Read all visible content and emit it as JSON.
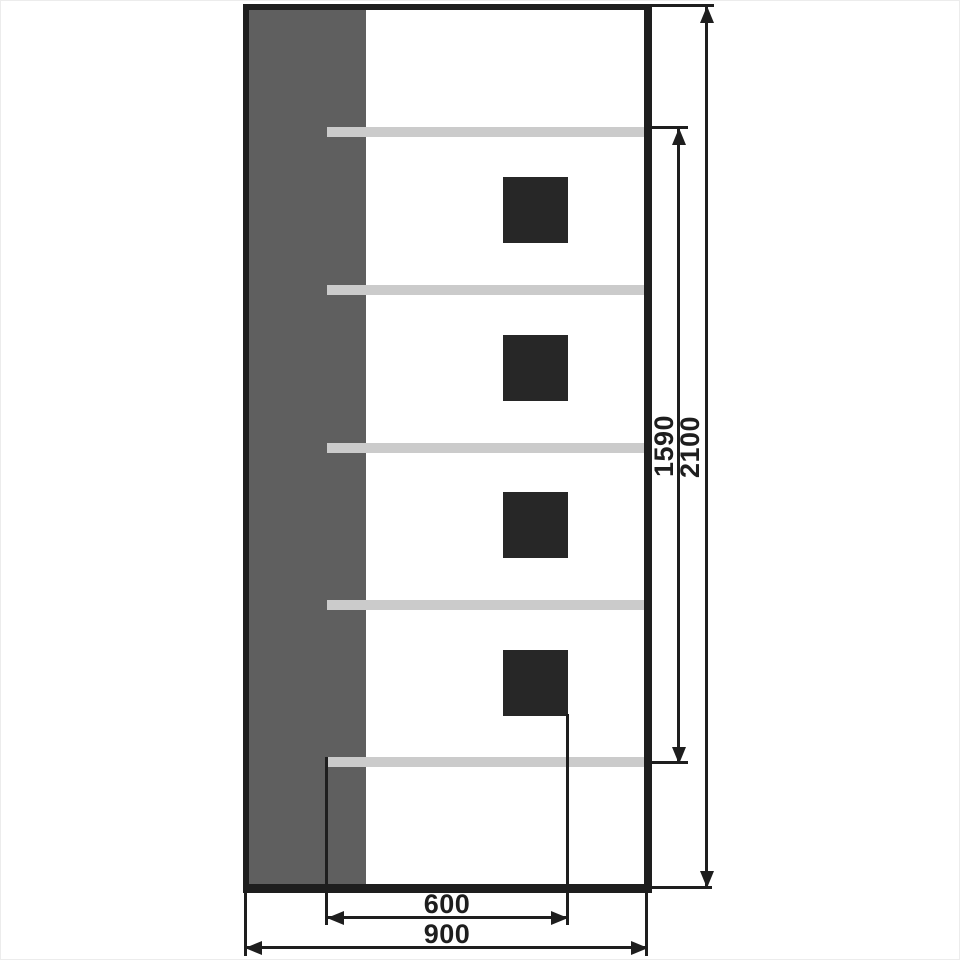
{
  "diagram": {
    "kind": "furniture-elevation-drawing",
    "dimensions": {
      "total_height": "2100",
      "opening_height": "1590",
      "opening_width": "600",
      "total_width": "900"
    },
    "shelf_count": 5,
    "handle_count": 4,
    "colors": {
      "line": "#1e1e1e",
      "side_panel": "#5f5f5f",
      "shelf": "#cbcbcb",
      "handle": "#272727",
      "background": "#ffffff"
    }
  }
}
